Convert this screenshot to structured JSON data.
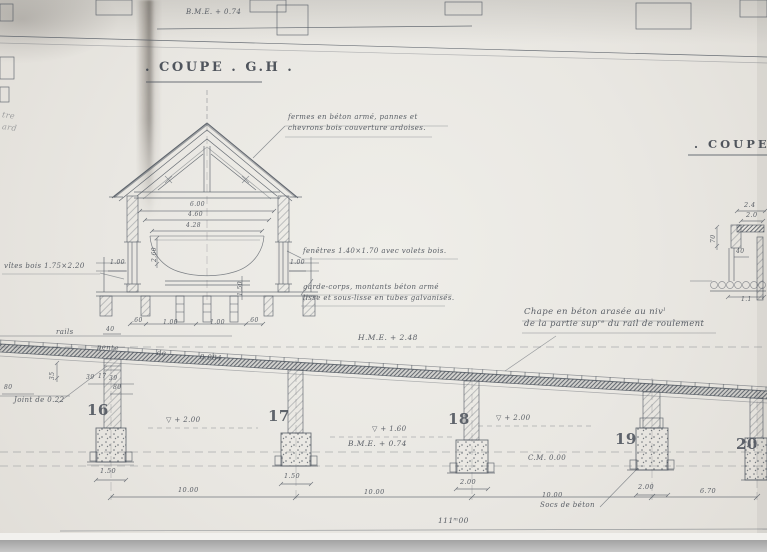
{
  "colors": {
    "paper": "#e9e7e2",
    "ink": "#454b54"
  },
  "header": {
    "bme_level": "B.M.E. + 0.74",
    "title": ". COUPE . G.H .",
    "right_title": ". COUPE ."
  },
  "notes": {
    "fermes_l1": "fermes en béton armé, pannes et",
    "fermes_l2": "chevrons bois couverture ardoises.",
    "fenetres": "fenêtres 1.40×1.70 avec volets bois.",
    "garde_l1": "garde-corps, montants béton armé",
    "garde_l2": "lisse et sous-lisse en tubes galvanisés.",
    "vites": "vîtes bois 1.75×2.20",
    "chape_l1": "Chape en béton arasée au nivˡ",
    "chape_l2": "de la partie supʳᵉ du rail de roulement",
    "rails": "rails",
    "pente_1": "pente",
    "pente_2": "de",
    "pente_3": "0.084",
    "joint": "Joint de 0.22",
    "socs": "Socs de béton",
    "scribble_1": "tre",
    "scribble_2": "ard"
  },
  "levels": {
    "hme": "H.M.E. + 2.48",
    "mid_bme": "B.M.E. + 0.74",
    "cm": "C.M. 0.00",
    "v2_left": "▽ + 2.00",
    "v2_right": "▽ + 2.00",
    "v16": "▽ + 1.60"
  },
  "piers": {
    "labels": [
      "16",
      "17",
      "18",
      "19",
      "20"
    ],
    "widths": [
      "1.50",
      "1.50",
      "2.00",
      "2.00"
    ],
    "spans": [
      "10.00",
      "10.00",
      "10.00"
    ],
    "end": "6.70",
    "total": "111ᵐ00"
  },
  "section_dims": {
    "w1": "6.00",
    "w2": "4.60",
    "w3": "4.28",
    "h1": "2.60",
    "eave_l": "1.00",
    "eave_r": "1.00",
    "v1": "1.50",
    "row": [
      ".60",
      "1.00",
      "1.00",
      ".60"
    ]
  },
  "column_dims": {
    "top": "40",
    "a": "39",
    "b": "17",
    "c": "39",
    "left": "80",
    "right": "80",
    "v": "35"
  },
  "detail_dims": {
    "a": "2.4",
    "b": "2.0",
    "c": "70",
    "d": "40",
    "e": "1.1"
  }
}
